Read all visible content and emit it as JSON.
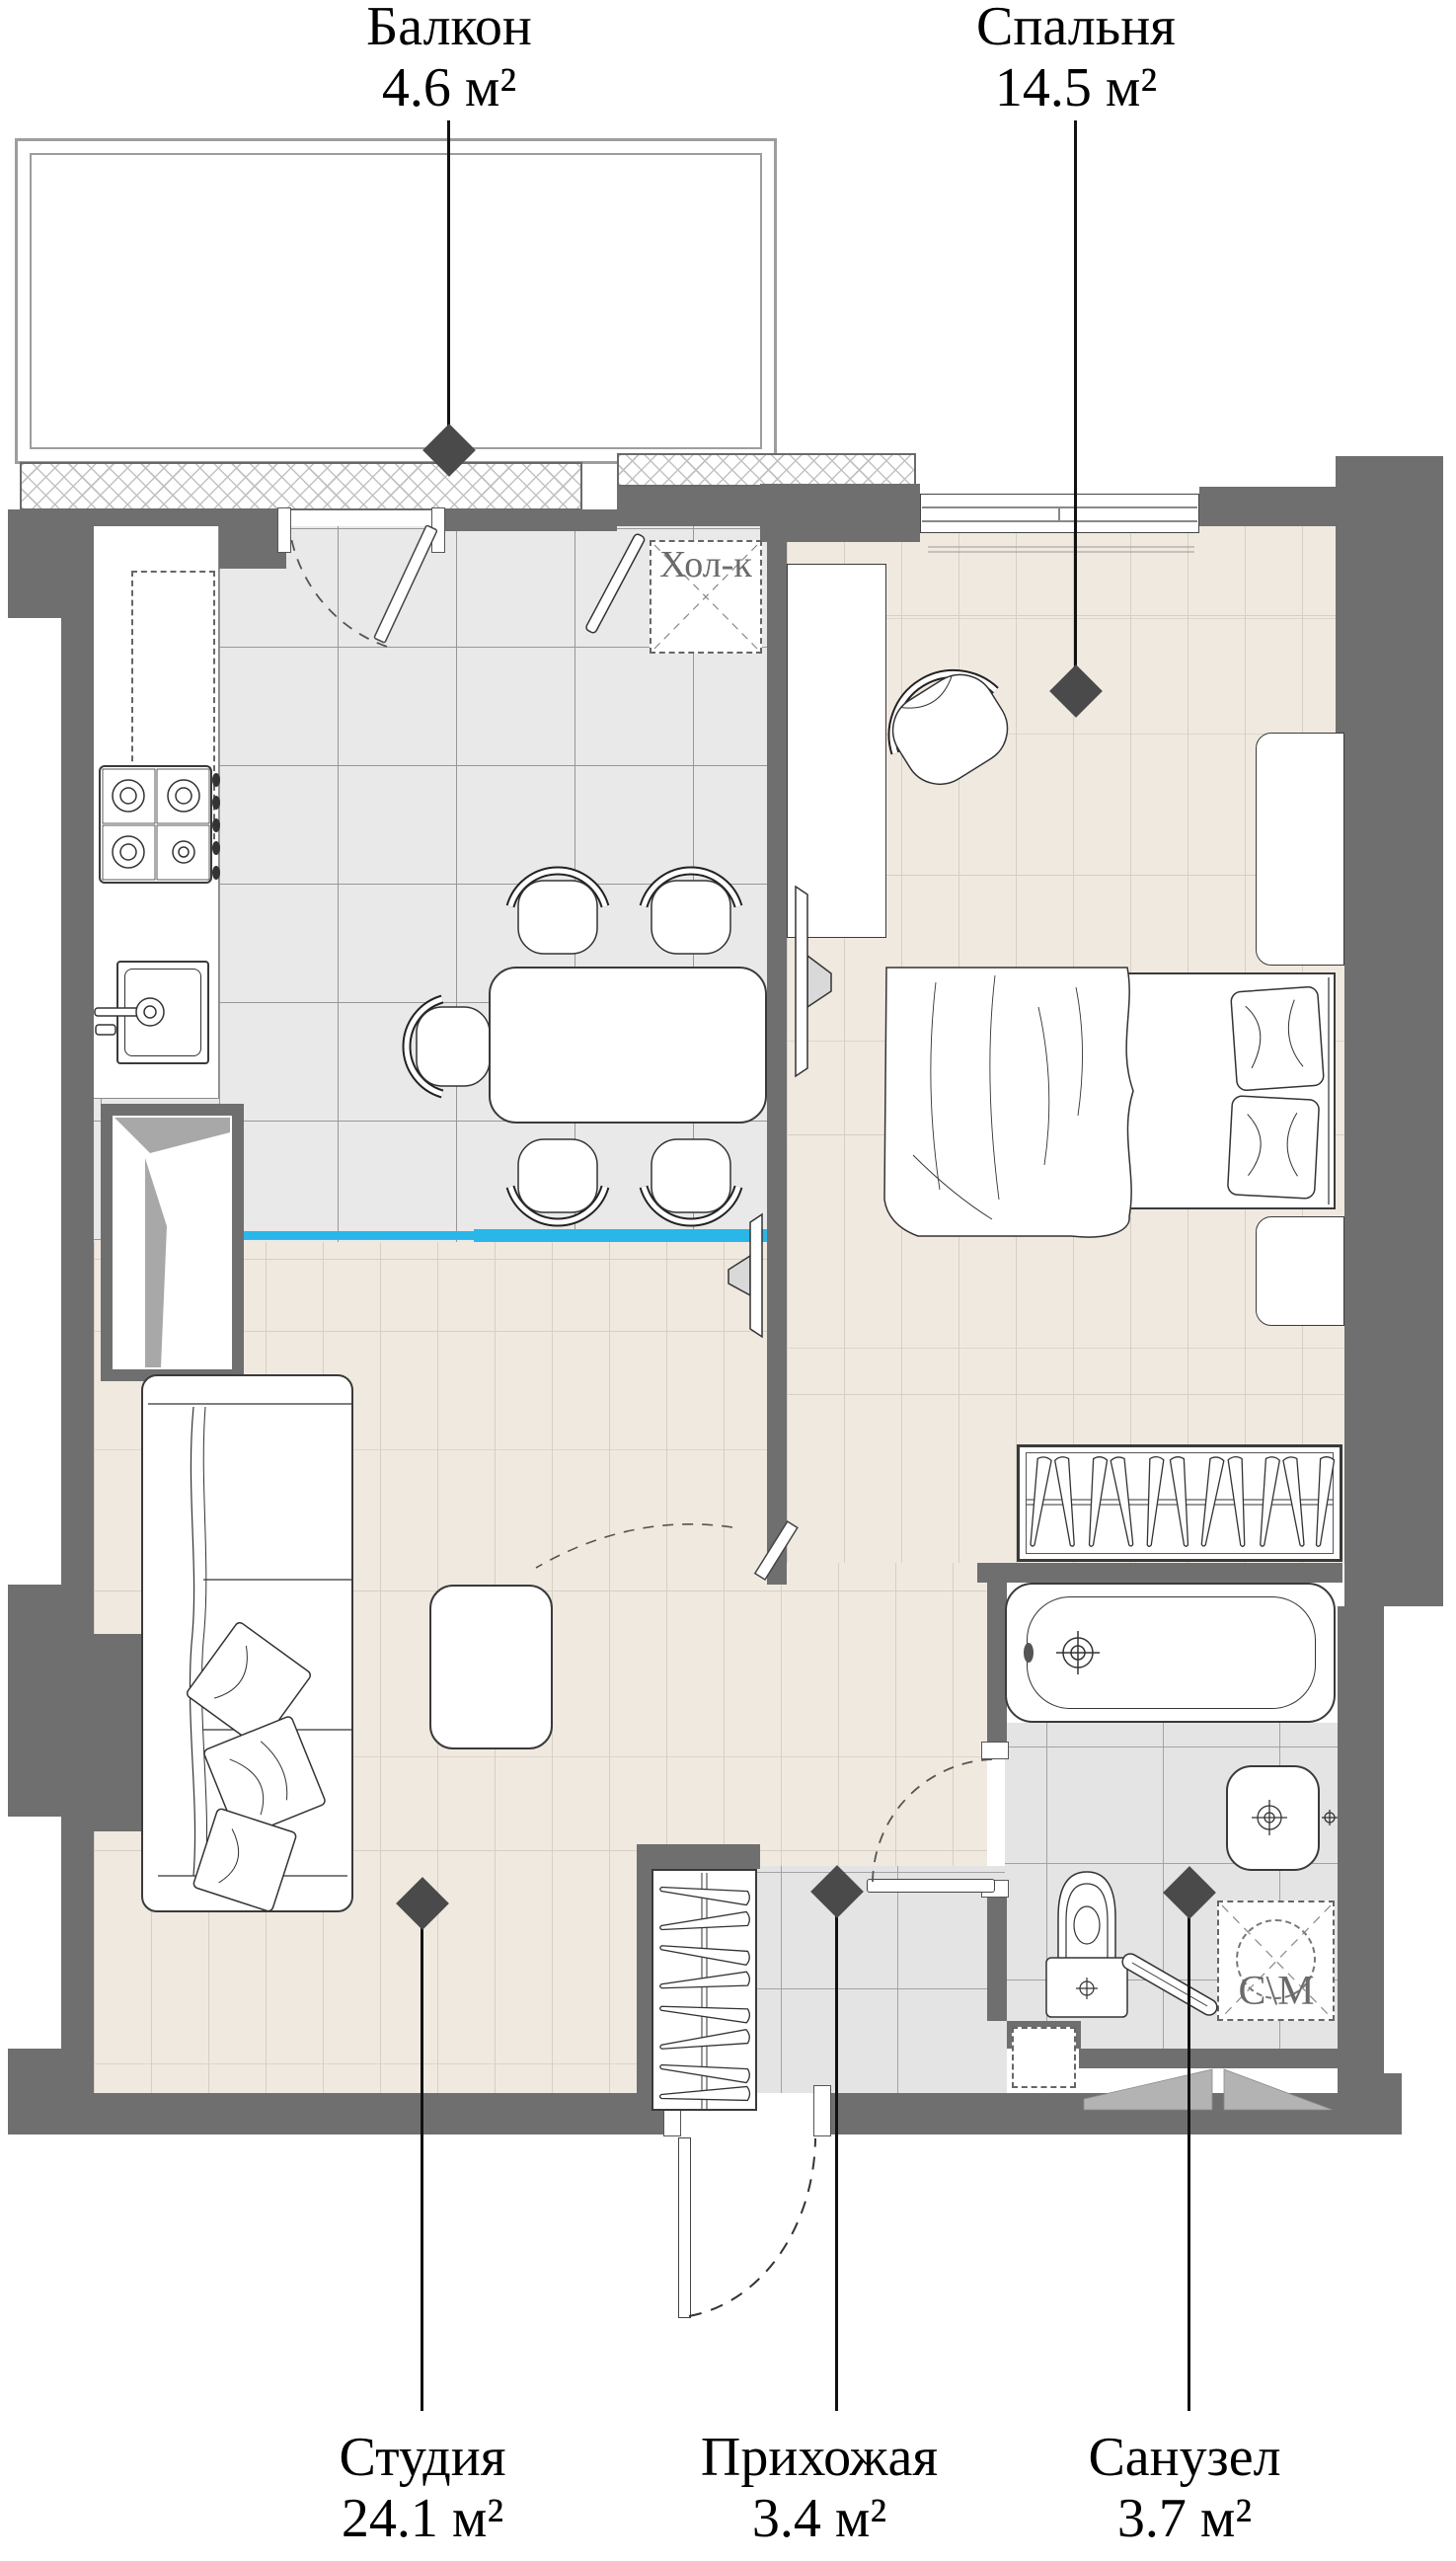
{
  "plan_title": "Studio apartment floor plan",
  "rooms": {
    "balcony": {
      "name": "Балкон",
      "area": "4.6 м²"
    },
    "bedroom": {
      "name": "Спальня",
      "area": "14.5 м²"
    },
    "studio": {
      "name": "Студия",
      "area": "24.1 м²"
    },
    "hallway": {
      "name": "Прихожая",
      "area": "3.4 м²"
    },
    "bathroom": {
      "name": "Санузел",
      "area": "3.7 м²"
    }
  },
  "appliances": {
    "fridge_label": "Хол-к",
    "washer_label": "С\\М"
  },
  "colors": {
    "wall": "#6f6f6f",
    "marker": "#4a4a4a",
    "zone_divider": "#29b7ea",
    "wood_floor": "#f0e9e0",
    "kitchen_tile": "#e9e9e9",
    "bath_tile": "#e4e4e4"
  },
  "fixtures": [
    "balcony-glazing",
    "kitchen-window",
    "bedroom-window",
    "gas-stove",
    "kitchen-sink",
    "fridge",
    "dining-table",
    "chairs",
    "kitchen-cabinet",
    "sofa",
    "coffee-table",
    "tv-studio",
    "tv-bedroom",
    "mirror",
    "desk",
    "armchair",
    "bed",
    "pillows",
    "dresser",
    "nightstand",
    "wardrobe-bedroom",
    "wardrobe-hallway",
    "bathtub",
    "wash-basin",
    "toilet",
    "washing-machine",
    "towel-rail",
    "entrance-door",
    "balcony-door",
    "bathroom-door"
  ]
}
